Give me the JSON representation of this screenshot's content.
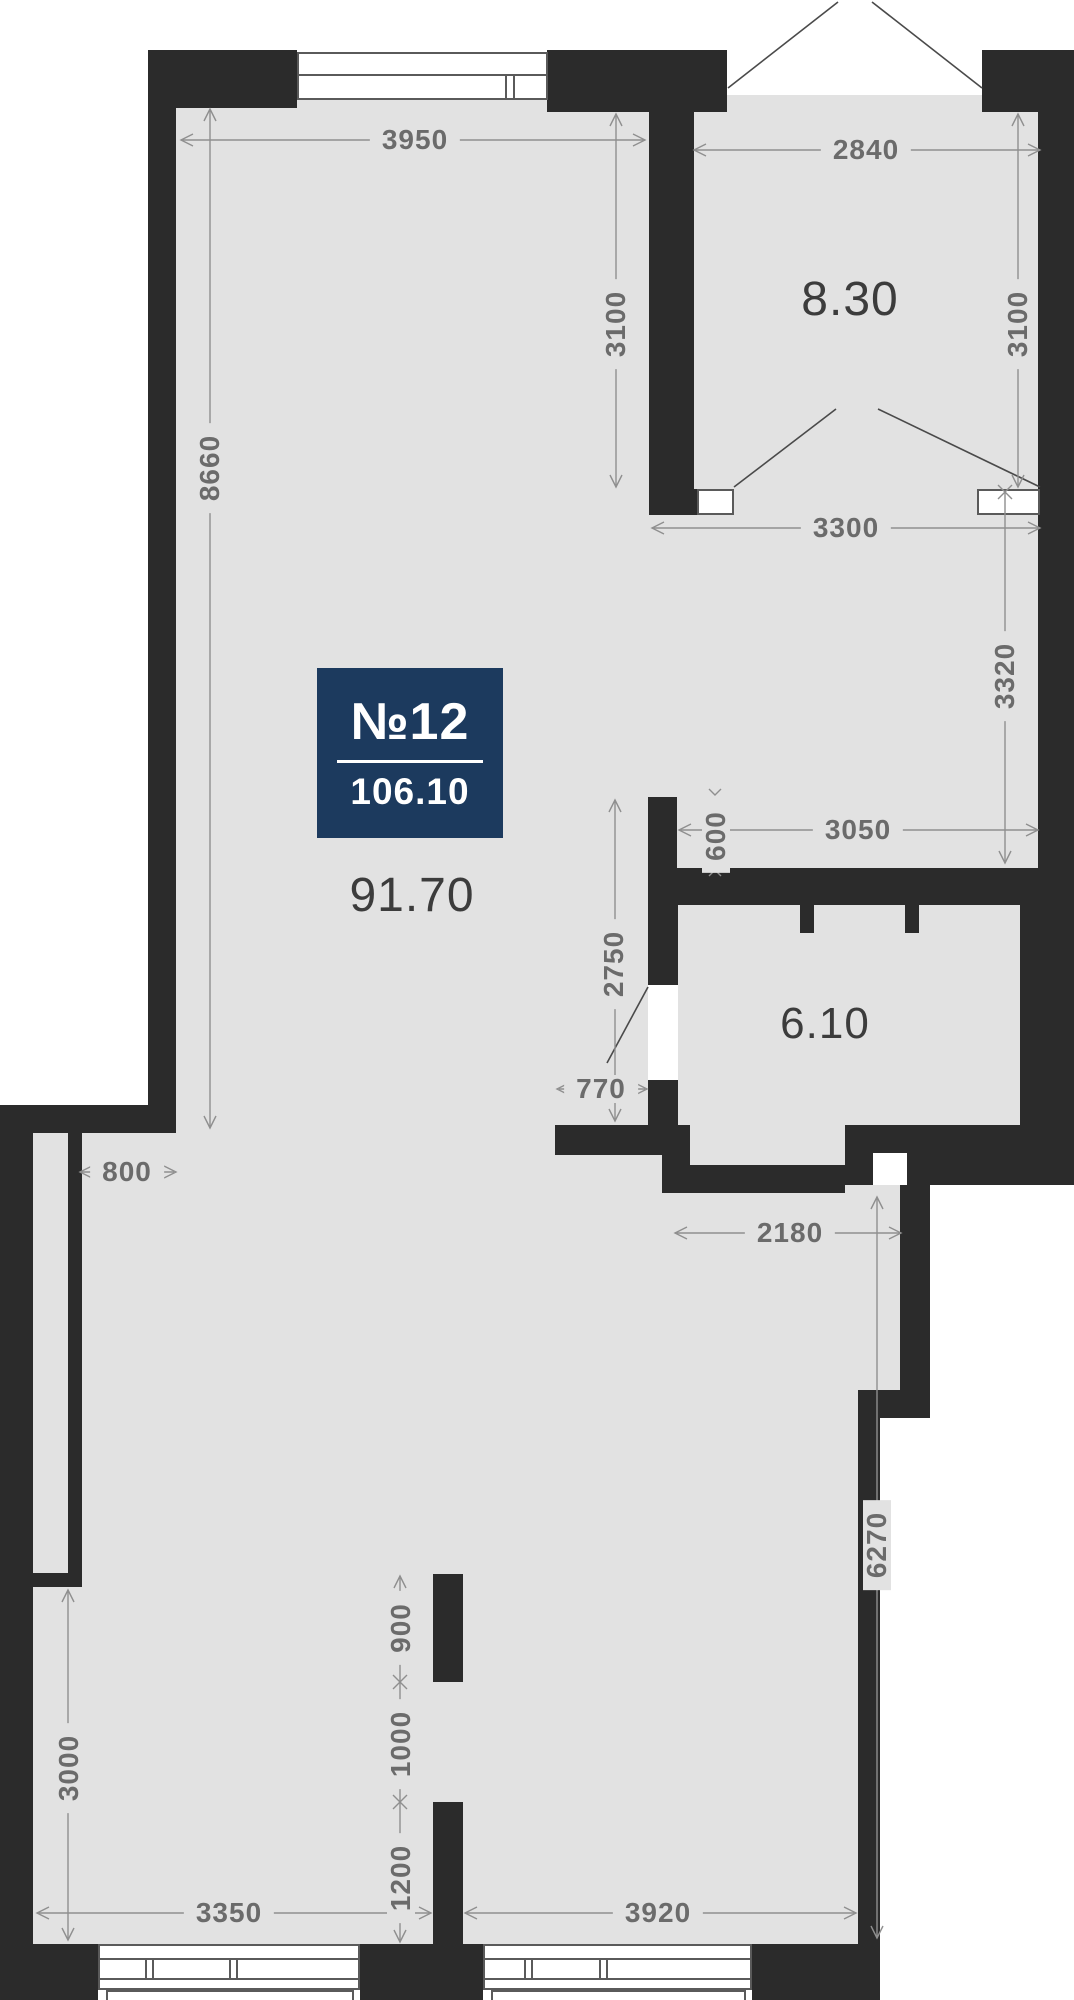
{
  "badge": {
    "number": "№12",
    "total_area": "106.10"
  },
  "areas": {
    "main": "91.70",
    "bedroom": "8.30",
    "bathroom": "6.10"
  },
  "dims": {
    "d3950": "3950",
    "d2840": "2840",
    "d3100_left": "3100",
    "d3100_right": "3100",
    "d3300": "3300",
    "d8660": "8660",
    "d3320": "3320",
    "d3050": "3050",
    "d600": "600",
    "d2750": "2750",
    "d770": "770",
    "d800": "800",
    "d2180": "2180",
    "d6270": "6270",
    "d3000": "3000",
    "d900": "900",
    "d1000": "1000",
    "d1200": "1200",
    "d3350": "3350",
    "d3920": "3920"
  },
  "colors": {
    "wall": "#2b2b2b",
    "floor": "#e2e2e2",
    "dim_text": "#6b6b6b",
    "dim_line": "#8f8f8f",
    "area_text": "#3c3c3c",
    "badge_bg": "#1c3a5e",
    "badge_text": "#ffffff",
    "outside": "#ffffff",
    "door_line": "#4a4a4a"
  }
}
